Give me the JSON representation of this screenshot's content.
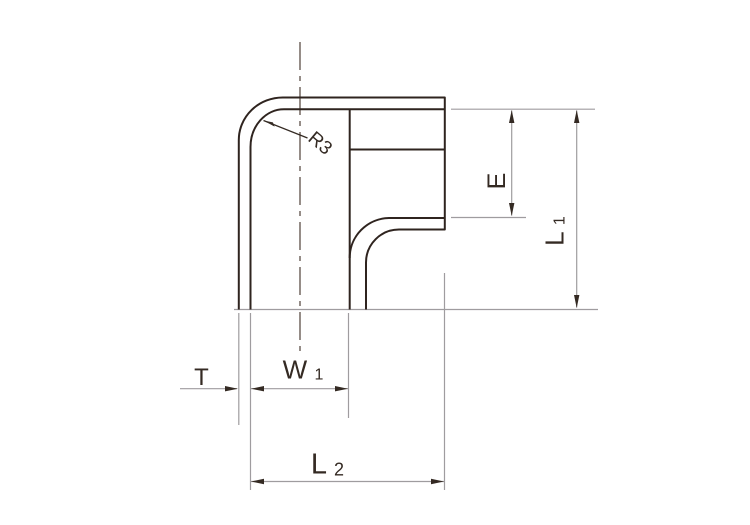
{
  "drawing": {
    "labels": {
      "radius_note": "R3",
      "wall_thickness": "T",
      "width_base": "W",
      "width_sub": "1",
      "overall_length_base": "L",
      "overall_length_sub": "2",
      "socket_depth": "E",
      "height_base": "L",
      "height_sub": "1"
    },
    "colors": {
      "outline": "#2f241f",
      "dimension_line": "#9f9c9f",
      "centerline": "#4f4138",
      "text": "#342a23",
      "background": "#ffffff"
    }
  }
}
